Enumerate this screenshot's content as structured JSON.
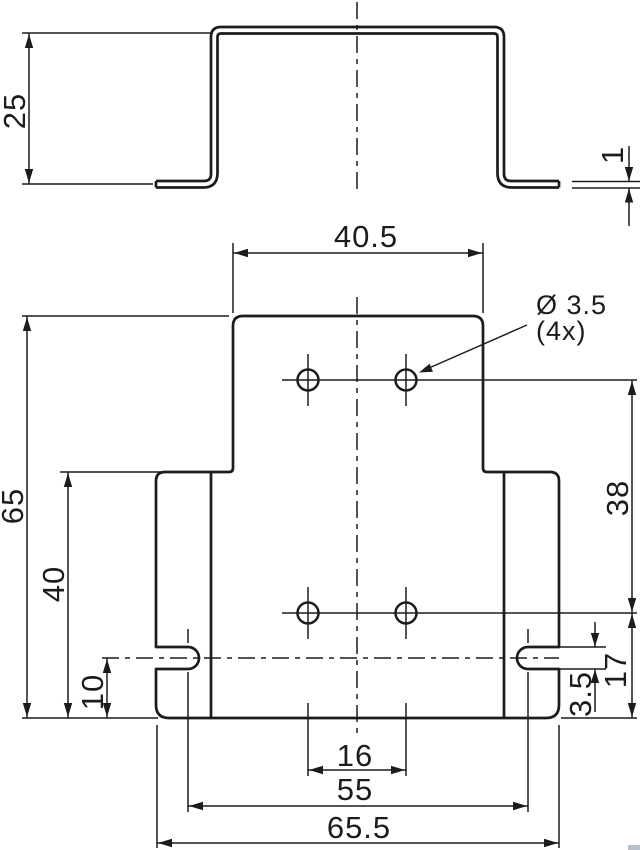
{
  "drawing": {
    "type": "technical-dimension-drawing",
    "line_color": "#1c1c1c",
    "background": "#ffffff",
    "side_view": {
      "height": "25",
      "material_thickness": "1"
    },
    "plan_view": {
      "top_width": "40.5",
      "hole_diameter": "Ø 3.5",
      "hole_count": "(4x)",
      "overall_height": "65",
      "base_height": "40",
      "slot_center_to_edge": "10",
      "hole_rows_spacing": "38",
      "hole_row_to_edge": "17",
      "slot_width": "3.5",
      "hole_columns_spacing": "16",
      "slots_spacing": "55",
      "overall_width": "65.5"
    }
  }
}
